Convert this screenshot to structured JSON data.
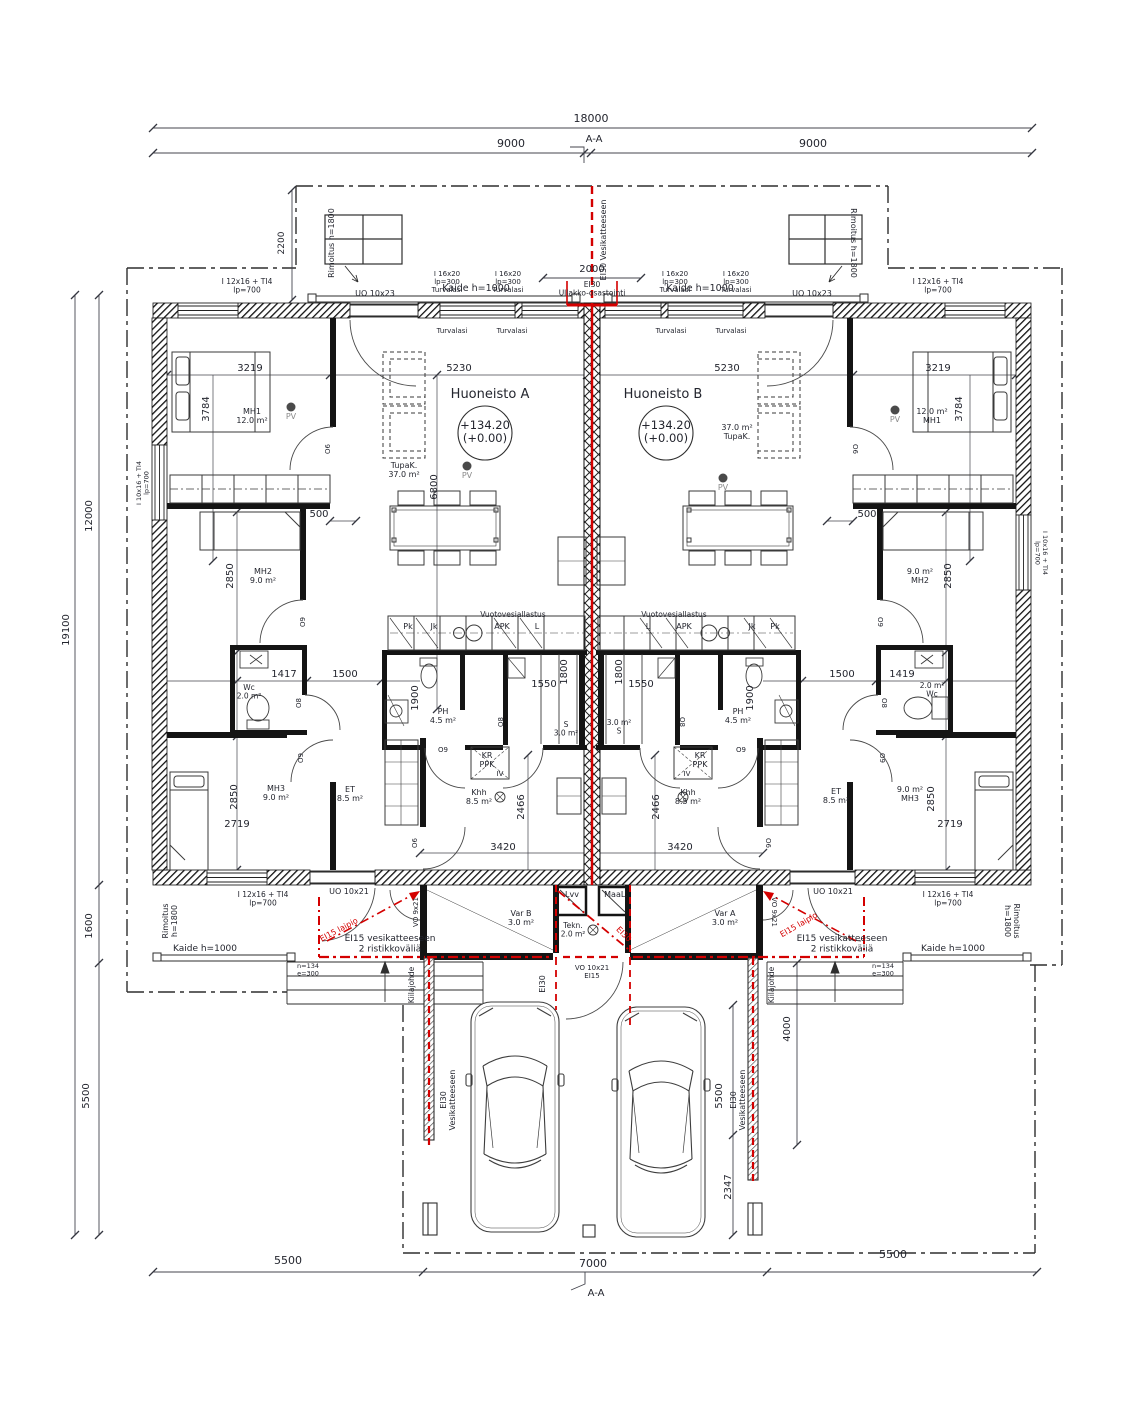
{
  "colors": {
    "background": "#ffffff",
    "line": "#2e2e2e",
    "wall": "#141414",
    "red": "#d40000",
    "text": "#23252e",
    "muted": "#8b8b8b",
    "dim": "#34363f"
  },
  "labels": [
    {
      "n": "dim-18000",
      "t": "18000",
      "x": 591,
      "y": 122,
      "s": 11
    },
    {
      "n": "dim-9000-left",
      "t": "9000",
      "x": 511,
      "y": 147,
      "s": 11
    },
    {
      "n": "dim-9000-right",
      "t": "9000",
      "x": 813,
      "y": 147,
      "s": 11
    },
    {
      "n": "section-marker-top",
      "t": "A-A",
      "x": 594,
      "y": 142,
      "s": 10
    },
    {
      "n": "label-ei30-vesikatteeseen-top",
      "t": "EI30 Vesikatteeseen",
      "x": 606,
      "y": 240,
      "r": -90,
      "s": 8
    },
    {
      "n": "dim-2000",
      "t": "2000",
      "x": 592,
      "y": 272,
      "s": 10
    },
    {
      "n": "dim-2200",
      "t": "2200",
      "x": 284,
      "y": 243,
      "r": -90,
      "s": 9
    },
    {
      "n": "label-rimoitus-top-left",
      "t": "Rimoitus h=1800",
      "x": 334,
      "y": 243,
      "r": -90,
      "s": 8
    },
    {
      "n": "label-rimoitus-top-right",
      "t": "Rimoitus h=1800",
      "x": 851,
      "y": 243,
      "r": 90,
      "s": 8
    },
    {
      "n": "label-kaide-top-left",
      "t": "Kaide h=1000",
      "x": 476,
      "y": 291,
      "s": 9.5
    },
    {
      "n": "label-kaide-top-right",
      "t": "Kaide h=1000",
      "x": 700,
      "y": 291,
      "s": 9.5
    },
    {
      "n": "win-label-i12x16-top-left",
      "t": "I 12x16 + TI4\nlp=700",
      "x": 247,
      "y": 284,
      "s": 7.5
    },
    {
      "n": "door-label-uo10x23-left",
      "t": "UO 10x23",
      "x": 375,
      "y": 296,
      "s": 8
    },
    {
      "n": "win-label-i16x20-left-1",
      "t": "I 16x20\nlp=300\nTurvalasi",
      "x": 447,
      "y": 276,
      "s": 7
    },
    {
      "n": "win-label-i16x20-left-2",
      "t": "I 16x20\nlp=300\nTurvalasi",
      "x": 508,
      "y": 276,
      "s": 7
    },
    {
      "n": "label-ei30-ullakko",
      "t": "EI30\nUllakko-osastointi",
      "x": 592,
      "y": 287,
      "s": 7.5
    },
    {
      "n": "win-label-i16x20-right-1",
      "t": "I 16x20\nlp=300\nTurvalasi",
      "x": 675,
      "y": 276,
      "s": 7
    },
    {
      "n": "win-label-i16x20-right-2",
      "t": "I 16x20\nlp=300\nTurvalasi",
      "x": 736,
      "y": 276,
      "s": 7
    },
    {
      "n": "door-label-uo10x23-right",
      "t": "UO 10x23",
      "x": 812,
      "y": 296,
      "s": 8
    },
    {
      "n": "win-label-i12x16-top-right",
      "t": "I 12x16 + TI4\nlp=700",
      "x": 938,
      "y": 284,
      "s": 7.5
    },
    {
      "n": "sill-turvalasi-1",
      "t": "Turvalasi",
      "x": 452,
      "y": 333,
      "s": 7
    },
    {
      "n": "sill-turvalasi-2",
      "t": "Turvalasi",
      "x": 512,
      "y": 333,
      "s": 7
    },
    {
      "n": "sill-turvalasi-3",
      "t": "Turvalasi",
      "x": 671,
      "y": 333,
      "s": 7
    },
    {
      "n": "sill-turvalasi-4",
      "t": "Turvalasi",
      "x": 731,
      "y": 333,
      "s": 7
    },
    {
      "n": "dim-12000",
      "t": "12000",
      "x": 92,
      "y": 516,
      "r": -90,
      "s": 10
    },
    {
      "n": "dim-19100",
      "t": "19100",
      "x": 69,
      "y": 630,
      "r": -90,
      "s": 10
    },
    {
      "n": "dim-1600",
      "t": "1600",
      "x": 92,
      "y": 926,
      "r": -90,
      "s": 10
    },
    {
      "n": "dim-5500-left",
      "t": "5500",
      "x": 89,
      "y": 1096,
      "r": -90,
      "s": 10
    },
    {
      "n": "win-label-i10x16-left",
      "t": "I 10x16 + TI4\nlp=700",
      "x": 141,
      "y": 483,
      "r": -90,
      "s": 6.5
    },
    {
      "n": "win-label-i10x16-right",
      "t": "I 10x16 + TI4\nlp=700",
      "x": 1043,
      "y": 553,
      "r": 90,
      "s": 6.5
    },
    {
      "n": "apartment-a-title",
      "t": "Huoneisto  A",
      "x": 490,
      "y": 398,
      "s": 13
    },
    {
      "n": "apartment-b-title",
      "t": "Huoneisto  B",
      "x": 663,
      "y": 398,
      "s": 13
    },
    {
      "n": "level-mark-a",
      "t": "+134.20\n(+0.00)",
      "x": 485,
      "y": 429,
      "s": 11.5
    },
    {
      "n": "level-mark-b",
      "t": "+134.20\n(+0.00)",
      "x": 666,
      "y": 429,
      "s": 11.5
    },
    {
      "n": "room-tupak-a",
      "t": "TupaK.\n37.0 m²",
      "x": 404,
      "y": 468,
      "s": 8
    },
    {
      "n": "room-tupak-b",
      "t": "37.0 m²\nTupaK.",
      "x": 737,
      "y": 430,
      "s": 8
    },
    {
      "n": "pv-label-a1",
      "t": "PV",
      "x": 467,
      "y": 478,
      "s": 8,
      "c": "muted"
    },
    {
      "n": "pv-label-a2",
      "t": "PV",
      "x": 291,
      "y": 419,
      "s": 8,
      "c": "muted"
    },
    {
      "n": "pv-label-b1",
      "t": "PV",
      "x": 895,
      "y": 422,
      "s": 8,
      "c": "muted"
    },
    {
      "n": "pv-label-b2",
      "t": "PV",
      "x": 723,
      "y": 490,
      "s": 8,
      "c": "muted"
    },
    {
      "n": "room-mh1-a",
      "t": "MH1\n12.0 m²",
      "x": 252,
      "y": 414,
      "s": 8
    },
    {
      "n": "room-mh1-b",
      "t": "12.0 m²\nMH1",
      "x": 932,
      "y": 414,
      "s": 8
    },
    {
      "n": "dim-3219-a",
      "t": "3219",
      "x": 250,
      "y": 371,
      "s": 10
    },
    {
      "n": "dim-3219-b",
      "t": "3219",
      "x": 938,
      "y": 371,
      "s": 10
    },
    {
      "n": "dim-3784-a",
      "t": "3784",
      "x": 209,
      "y": 409,
      "r": -90,
      "s": 10
    },
    {
      "n": "dim-3784-b",
      "t": "3784",
      "x": 962,
      "y": 409,
      "r": -90,
      "s": 10
    },
    {
      "n": "dim-5230-a",
      "t": "5230",
      "x": 459,
      "y": 371,
      "s": 10
    },
    {
      "n": "dim-5230-b",
      "t": "5230",
      "x": 727,
      "y": 371,
      "s": 10
    },
    {
      "n": "dim-6800",
      "t": "6800",
      "x": 437,
      "y": 487,
      "r": -90,
      "s": 10
    },
    {
      "n": "dim-500-a",
      "t": "500",
      "x": 319,
      "y": 517,
      "s": 10
    },
    {
      "n": "dim-500-b",
      "t": "500",
      "x": 867,
      "y": 517,
      "s": 10
    },
    {
      "n": "room-mh2-a",
      "t": "MH2\n9.0 m²",
      "x": 263,
      "y": 574,
      "s": 8
    },
    {
      "n": "room-mh2-b",
      "t": "9.0 m²\nMH2",
      "x": 920,
      "y": 574,
      "s": 8
    },
    {
      "n": "dim-2850-a",
      "t": "2850",
      "x": 233,
      "y": 576,
      "r": -90,
      "s": 10
    },
    {
      "n": "dim-2850-b",
      "t": "2850",
      "x": 951,
      "y": 576,
      "r": -90,
      "s": 10
    },
    {
      "n": "dim-1417",
      "t": "1417",
      "x": 284,
      "y": 677,
      "s": 10
    },
    {
      "n": "dim-1419",
      "t": "1419",
      "x": 902,
      "y": 677,
      "s": 10
    },
    {
      "n": "dim-1500-a",
      "t": "1500",
      "x": 345,
      "y": 677,
      "s": 10
    },
    {
      "n": "dim-1500-b",
      "t": "1500",
      "x": 842,
      "y": 677,
      "s": 10
    },
    {
      "n": "room-wc-a",
      "t": "Wc\n2.0 m²",
      "x": 249,
      "y": 690,
      "s": 7.5
    },
    {
      "n": "room-wc-b",
      "t": "2.0 m²\nWc",
      "x": 932,
      "y": 688,
      "s": 7.5
    },
    {
      "n": "dim-1900-a",
      "t": "1900",
      "x": 418,
      "y": 698,
      "r": -90,
      "s": 10
    },
    {
      "n": "dim-1900-b",
      "t": "1900",
      "x": 753,
      "y": 698,
      "r": -90,
      "s": 10
    },
    {
      "n": "room-ph-a",
      "t": "PH\n4.5 m²",
      "x": 443,
      "y": 714,
      "s": 8
    },
    {
      "n": "room-ph-b",
      "t": "PH\n4.5 m²",
      "x": 738,
      "y": 714,
      "s": 8
    },
    {
      "n": "dim-1550-a",
      "t": "1550",
      "x": 544,
      "y": 687,
      "s": 10
    },
    {
      "n": "dim-1550-b",
      "t": "1550",
      "x": 641,
      "y": 687,
      "s": 10
    },
    {
      "n": "dim-1800-a",
      "t": "1800",
      "x": 567,
      "y": 672,
      "r": -90,
      "s": 10
    },
    {
      "n": "dim-1800-b",
      "t": "1800",
      "x": 622,
      "y": 672,
      "r": -90,
      "s": 10
    },
    {
      "n": "room-s-a",
      "t": "S\n3.0 m²",
      "x": 566,
      "y": 727,
      "s": 7.5
    },
    {
      "n": "room-s-b",
      "t": "3.0 m²\nS",
      "x": 619,
      "y": 725,
      "s": 7.5
    },
    {
      "n": "closet-kr-ppk-a",
      "t": "KR\nPPK",
      "x": 487,
      "y": 758,
      "s": 8
    },
    {
      "n": "closet-iv-a",
      "t": "IV",
      "x": 500,
      "y": 776,
      "s": 7
    },
    {
      "n": "closet-kr-ppk-b",
      "t": "KR\nPPK",
      "x": 700,
      "y": 758,
      "s": 8
    },
    {
      "n": "closet-iv-b",
      "t": "IV",
      "x": 687,
      "y": 776,
      "s": 7
    },
    {
      "n": "label-vuotovesiallastus-a",
      "t": "Vuotovesiallastus",
      "x": 513,
      "y": 617,
      "s": 7.5
    },
    {
      "n": "label-vuotovesiallastus-b",
      "t": "Vuotovesiallastus",
      "x": 674,
      "y": 617,
      "s": 7.5
    },
    {
      "n": "appliance-pk-a",
      "t": "Pk",
      "x": 408,
      "y": 629,
      "s": 8
    },
    {
      "n": "appliance-jk-a",
      "t": "Jk",
      "x": 434,
      "y": 629,
      "s": 8
    },
    {
      "n": "appliance-apk-a",
      "t": "APK",
      "x": 502,
      "y": 629,
      "s": 8
    },
    {
      "n": "appliance-l-a",
      "t": "L",
      "x": 537,
      "y": 629,
      "s": 8
    },
    {
      "n": "appliance-l-b",
      "t": "L",
      "x": 648,
      "y": 629,
      "s": 8
    },
    {
      "n": "appliance-apk-b",
      "t": "APK",
      "x": 684,
      "y": 629,
      "s": 8
    },
    {
      "n": "appliance-jk-b",
      "t": "Jk",
      "x": 752,
      "y": 629,
      "s": 8
    },
    {
      "n": "appliance-pk-b",
      "t": "Pk",
      "x": 775,
      "y": 629,
      "s": 8
    },
    {
      "n": "room-mh3-a",
      "t": "MH3\n9.0 m²",
      "x": 276,
      "y": 791,
      "s": 8
    },
    {
      "n": "room-mh3-b",
      "t": "9.0 m²\nMH3",
      "x": 910,
      "y": 792,
      "s": 8
    },
    {
      "n": "room-et-a",
      "t": "ET\n8.5 m²",
      "x": 350,
      "y": 792,
      "s": 8
    },
    {
      "n": "room-et-b",
      "t": "ET\n8.5 m²",
      "x": 836,
      "y": 794,
      "s": 8
    },
    {
      "n": "room-khh-a",
      "t": "Khh\n8.5 m²",
      "x": 479,
      "y": 795,
      "s": 8
    },
    {
      "n": "room-khh-b",
      "t": "Khh\n8.5 m²",
      "x": 688,
      "y": 795,
      "s": 8
    },
    {
      "n": "dim-2850-mh3-a",
      "t": "2850",
      "x": 237,
      "y": 797,
      "r": -90,
      "s": 10
    },
    {
      "n": "dim-2850-mh3-b",
      "t": "2850",
      "x": 934,
      "y": 799,
      "r": -90,
      "s": 10
    },
    {
      "n": "dim-2719-a",
      "t": "2719",
      "x": 237,
      "y": 827,
      "s": 10
    },
    {
      "n": "dim-2719-b",
      "t": "2719",
      "x": 950,
      "y": 827,
      "s": 10
    },
    {
      "n": "dim-2466-a",
      "t": "2466",
      "x": 524,
      "y": 807,
      "r": -90,
      "s": 10
    },
    {
      "n": "dim-2466-b",
      "t": "2466",
      "x": 659,
      "y": 807,
      "r": -90,
      "s": 10
    },
    {
      "n": "dim-3420-a",
      "t": "3420",
      "x": 503,
      "y": 850,
      "s": 10
    },
    {
      "n": "dim-3420-b",
      "t": "3420",
      "x": 680,
      "y": 850,
      "s": 10
    },
    {
      "n": "door-tag-o6-a",
      "t": "O6",
      "x": 330,
      "y": 449,
      "r": -90,
      "s": 7
    },
    {
      "n": "door-tag-o6-b",
      "t": "O6",
      "x": 853,
      "y": 449,
      "r": 90,
      "s": 7
    },
    {
      "n": "door-tag-o9-mh2-a",
      "t": "O9",
      "x": 305,
      "y": 622,
      "r": -90,
      "s": 7
    },
    {
      "n": "door-tag-o9-mh2-b",
      "t": "O9",
      "x": 878,
      "y": 622,
      "r": 90,
      "s": 7
    },
    {
      "n": "door-tag-o8-wc-a",
      "t": "O8",
      "x": 301,
      "y": 703,
      "r": -90,
      "s": 7
    },
    {
      "n": "door-tag-o8-wc-b",
      "t": "O8",
      "x": 882,
      "y": 703,
      "r": 90,
      "s": 7
    },
    {
      "n": "door-tag-o8-s-a",
      "t": "O8",
      "x": 503,
      "y": 722,
      "r": -90,
      "s": 7
    },
    {
      "n": "door-tag-o8-s-b",
      "t": "O8",
      "x": 680,
      "y": 722,
      "r": 90,
      "s": 7
    },
    {
      "n": "door-tag-o9-ph-a",
      "t": "O9",
      "x": 443,
      "y": 752,
      "s": 7
    },
    {
      "n": "door-tag-o9-ph-b",
      "t": "O9",
      "x": 741,
      "y": 752,
      "s": 7
    },
    {
      "n": "door-tag-o9-mh3-a",
      "t": "O9",
      "x": 303,
      "y": 758,
      "r": -90,
      "s": 7
    },
    {
      "n": "door-tag-o9-mh3-b",
      "t": "O9",
      "x": 880,
      "y": 758,
      "r": 90,
      "s": 7
    },
    {
      "n": "door-tag-o6-entry-a",
      "t": "O6",
      "x": 417,
      "y": 843,
      "r": -90,
      "s": 7
    },
    {
      "n": "door-tag-o6-entry-b",
      "t": "O6",
      "x": 766,
      "y": 843,
      "r": 90,
      "s": 7
    },
    {
      "n": "closet-lvv",
      "t": "Lvv",
      "x": 572,
      "y": 897,
      "s": 8
    },
    {
      "n": "closet-maal",
      "t": "MaaL.",
      "x": 616,
      "y": 897,
      "s": 8
    },
    {
      "n": "room-var-b",
      "t": "Var B\n3.0 m²",
      "x": 521,
      "y": 916,
      "s": 8
    },
    {
      "n": "room-var-a",
      "t": "Var A\n3.0 m²",
      "x": 725,
      "y": 916,
      "s": 8
    },
    {
      "n": "room-tekn",
      "t": "Tekn.\n2.0 m²",
      "x": 573,
      "y": 928,
      "s": 7.5
    },
    {
      "n": "label-ei30-tekn",
      "t": "EI30",
      "x": 622,
      "y": 936,
      "r": 45,
      "s": 8,
      "c": "red"
    },
    {
      "n": "door-label-vo9x21-left",
      "t": "VO 9x21",
      "x": 418,
      "y": 912,
      "r": -90,
      "s": 7
    },
    {
      "n": "door-label-vo9x21-right",
      "t": "VO 9x21",
      "x": 772,
      "y": 912,
      "r": 90,
      "s": 7
    },
    {
      "n": "door-label-uo10x21-left",
      "t": "UO 10x21",
      "x": 349,
      "y": 894,
      "s": 8
    },
    {
      "n": "door-label-uo10x21-right",
      "t": "UO 10x21",
      "x": 833,
      "y": 894,
      "s": 8
    },
    {
      "n": "win-label-i12x16-bottom-left",
      "t": "I 12x16 + TI4\nlp=700",
      "x": 263,
      "y": 897,
      "s": 7.5
    },
    {
      "n": "win-label-i12x16-bottom-right",
      "t": "I 12x16 + TI4\nlp=700",
      "x": 948,
      "y": 897,
      "s": 7.5
    },
    {
      "n": "label-ei15-laipio-left",
      "t": "EI15 laipio",
      "x": 340,
      "y": 932,
      "r": -28,
      "s": 8,
      "c": "red"
    },
    {
      "n": "label-ei15-laipio-right",
      "t": "EI15 laipio",
      "x": 800,
      "y": 927,
      "r": -30,
      "s": 8,
      "c": "red"
    },
    {
      "n": "label-ei15-vesik-left",
      "t": "EI15 vesikatteeseen\n2 ristikkoväliä",
      "x": 390,
      "y": 941,
      "s": 9
    },
    {
      "n": "label-ei15-vesik-right",
      "t": "EI15 vesikatteeseen\n2 ristikkoväliä",
      "x": 842,
      "y": 941,
      "s": 9
    },
    {
      "n": "label-n134-left",
      "t": "n=134\ne=300",
      "x": 308,
      "y": 968,
      "s": 6.5
    },
    {
      "n": "label-n134-right",
      "t": "n=134\ne=300",
      "x": 883,
      "y": 968,
      "s": 6.5
    },
    {
      "n": "label-kiilajohde-left",
      "t": "Kiilajohde",
      "x": 414,
      "y": 985,
      "r": -90,
      "s": 7.5
    },
    {
      "n": "label-kiilajohde-right",
      "t": "Kiilajohde",
      "x": 774,
      "y": 985,
      "r": -90,
      "s": 7.5
    },
    {
      "n": "label-rimoitus-bottom-left",
      "t": "Rimoitus\nh=1800",
      "x": 168,
      "y": 921,
      "r": -90,
      "s": 8
    },
    {
      "n": "label-rimoitus-bottom-right",
      "t": "Rimoitus\nh=1800",
      "x": 1014,
      "y": 921,
      "r": 90,
      "s": 8
    },
    {
      "n": "label-kaide-bottom-left",
      "t": "Kaide h=1000",
      "x": 205,
      "y": 951,
      "s": 9
    },
    {
      "n": "label-kaide-bottom-right",
      "t": "Kaide h=1000",
      "x": 953,
      "y": 951,
      "s": 9
    },
    {
      "n": "door-label-vo10x21-center",
      "t": "VO 10x21\nEI15",
      "x": 592,
      "y": 970,
      "s": 7
    },
    {
      "n": "label-ei30-center-below",
      "t": "EI30",
      "x": 545,
      "y": 984,
      "r": -90,
      "s": 8
    },
    {
      "n": "label-ei30-vesik-carport-left",
      "t": "EI30\nVesikatteeseen",
      "x": 446,
      "y": 1100,
      "r": -90,
      "s": 8
    },
    {
      "n": "label-ei30-vesik-carport-right",
      "t": "EI30\nVesikatteeseen",
      "x": 736,
      "y": 1100,
      "r": -90,
      "s": 8
    },
    {
      "n": "dim-4000",
      "t": "4000",
      "x": 790,
      "y": 1029,
      "r": -90,
      "s": 10
    },
    {
      "n": "dim-5500-carport",
      "t": "5500",
      "x": 722,
      "y": 1096,
      "r": -90,
      "s": 10
    },
    {
      "n": "dim-2347",
      "t": "2347",
      "x": 731,
      "y": 1187,
      "r": -90,
      "s": 10
    },
    {
      "n": "dim-5500-bottom-left",
      "t": "5500",
      "x": 288,
      "y": 1264,
      "s": 11
    },
    {
      "n": "dim-7000",
      "t": "7000",
      "x": 593,
      "y": 1267,
      "s": 11
    },
    {
      "n": "dim-5500-bottom-right",
      "t": "5500",
      "x": 893,
      "y": 1258,
      "s": 11
    },
    {
      "n": "section-marker-bottom",
      "t": "A-A",
      "x": 596,
      "y": 1296,
      "s": 10
    }
  ]
}
